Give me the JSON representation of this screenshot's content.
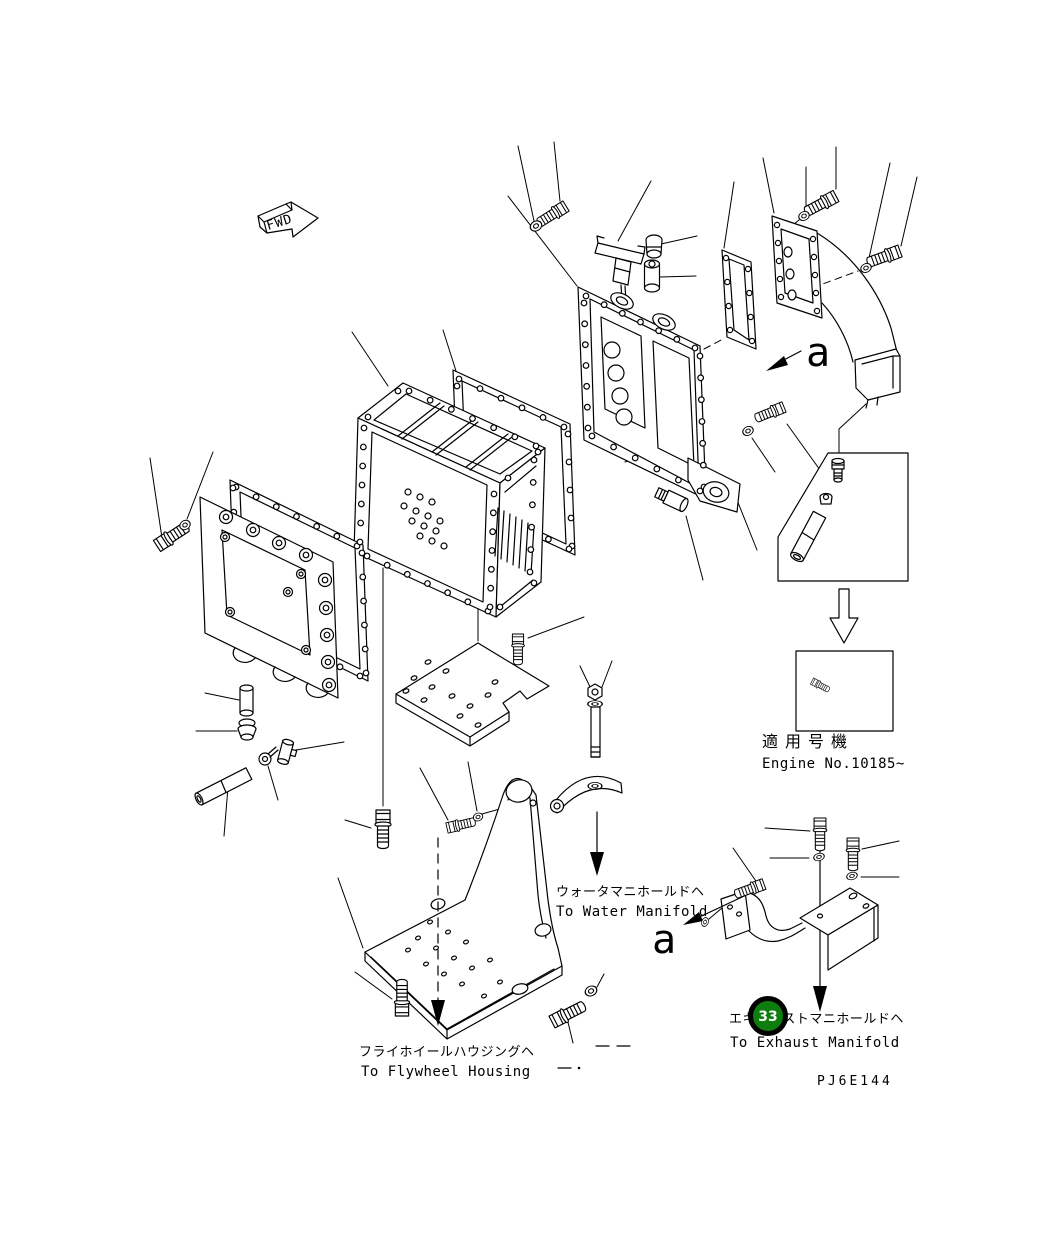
{
  "labels": {
    "fwd": "FWD",
    "view_a_top": "a",
    "view_a_bottom": "a",
    "callout_33": "33",
    "drawing_code": "PJ6E144"
  },
  "annotations": {
    "water_manifold": {
      "jp": "ウォータマニホールドヘ",
      "en": "To Water Manifold"
    },
    "flywheel_housing": {
      "jp": "フライホイールハウジングヘ",
      "en": "To Flywheel Housing"
    },
    "exhaust_manifold": {
      "jp": "エキゾーストマニホールドヘ",
      "en": "To Exhaust Manifold"
    },
    "applicability": {
      "jp": "適用号機",
      "en": "Engine No.10185~"
    }
  },
  "colors": {
    "line": "#000000",
    "callout_fill": "#0d7d0d",
    "callout_ring": "#000000",
    "callout_text": "#ffffff"
  }
}
